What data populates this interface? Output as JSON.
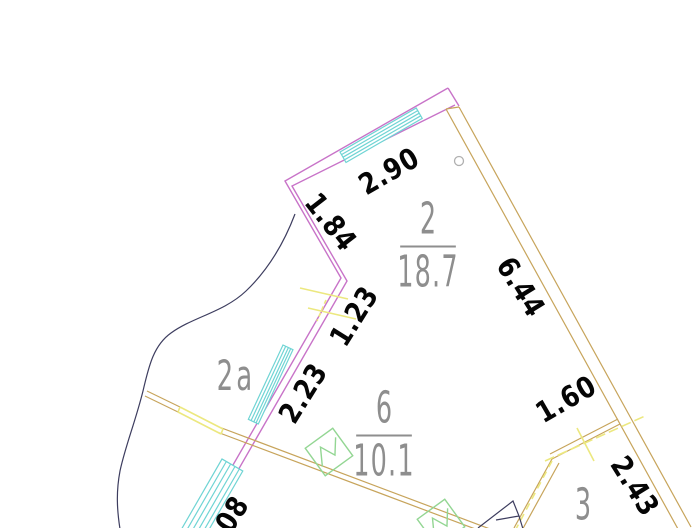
{
  "dimensions": {
    "top_window": "2.90",
    "wall_upper": "1.84",
    "wall_door": "1.23",
    "wall_window": "2.23",
    "main_wall": "6.44",
    "partition": "1.60",
    "main_wall_lower": "2.43",
    "bottom_window": "08"
  },
  "rooms": {
    "room2": {
      "number": "2",
      "area": "18.7"
    },
    "room6": {
      "number": "6",
      "area": "10.1"
    },
    "room3": {
      "number": "3"
    }
  },
  "zone": {
    "label": "2a"
  },
  "colors": {
    "wall": "#c873c8",
    "window": "#6fd4d4",
    "partition": "#c7a45b",
    "opening": "#ece87f",
    "vent": "#93d693",
    "dark": "#3d3d5f",
    "marker": "#b0b0b0",
    "dim_text": "#050505",
    "room_text": "#8e8e8e"
  }
}
